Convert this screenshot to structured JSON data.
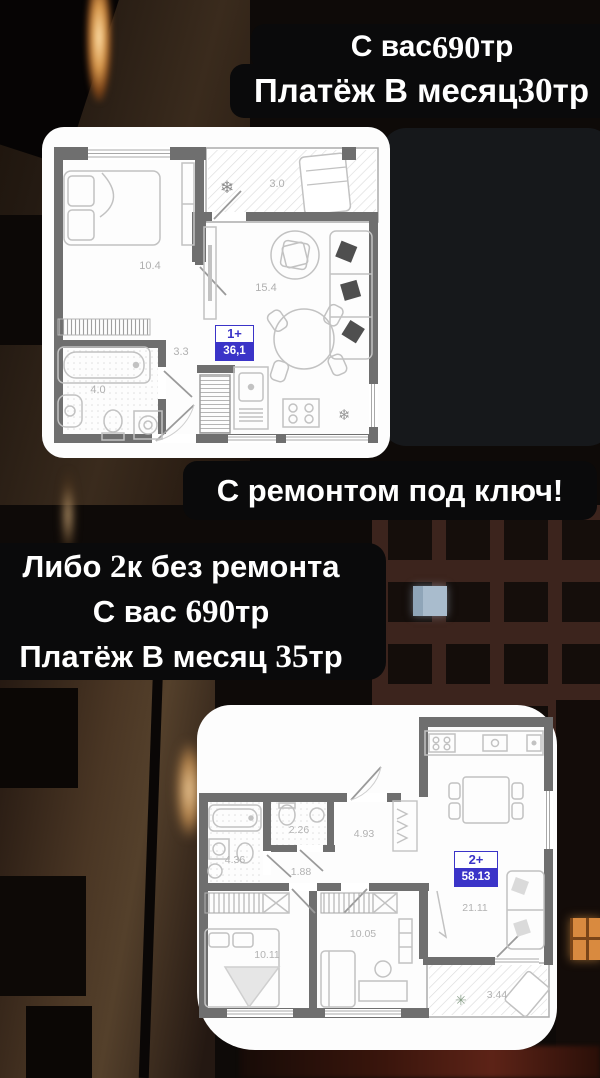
{
  "colors": {
    "badge_blue": "#3b34c8",
    "wall_gray": "#6f6f6f",
    "banner_black": "#0a0a0b",
    "card_white": "#fdfdfd"
  },
  "icons": {
    "snowflake": "❄",
    "plant": "✳"
  },
  "banners": {
    "top": {
      "line1": {
        "pre": "С вас ",
        "num": "690",
        "post": "тр"
      },
      "line2": {
        "pre": "Платёж В месяц ",
        "num": "30",
        "post": "тр"
      }
    },
    "mid": {
      "text": "С ремонтом под ключ!"
    },
    "offer": {
      "line1": {
        "pre": "Либо ",
        "num": "2",
        "post": "к без ремонта"
      },
      "line2": {
        "pre": "С вас ",
        "num": "690",
        "post": "тр"
      },
      "line3": {
        "pre": "Платёж В месяц ",
        "num": "35",
        "post": "тр"
      }
    }
  },
  "plan1": {
    "badge": {
      "type": "1+",
      "area": "36,1"
    },
    "labels": {
      "bedroom": "10.4",
      "living": "15.4",
      "hall": "3.3",
      "bath": "4.0",
      "balcony": "3.0"
    }
  },
  "plan2": {
    "badge": {
      "type": "2+",
      "area": "58.13"
    },
    "labels": {
      "bath": "4.36",
      "wc": "2.26",
      "corridor": "1.88",
      "hall": "4.93",
      "room2": "10.05",
      "bedroom": "10.11",
      "living": "21.11",
      "balcony": "3.44"
    }
  }
}
